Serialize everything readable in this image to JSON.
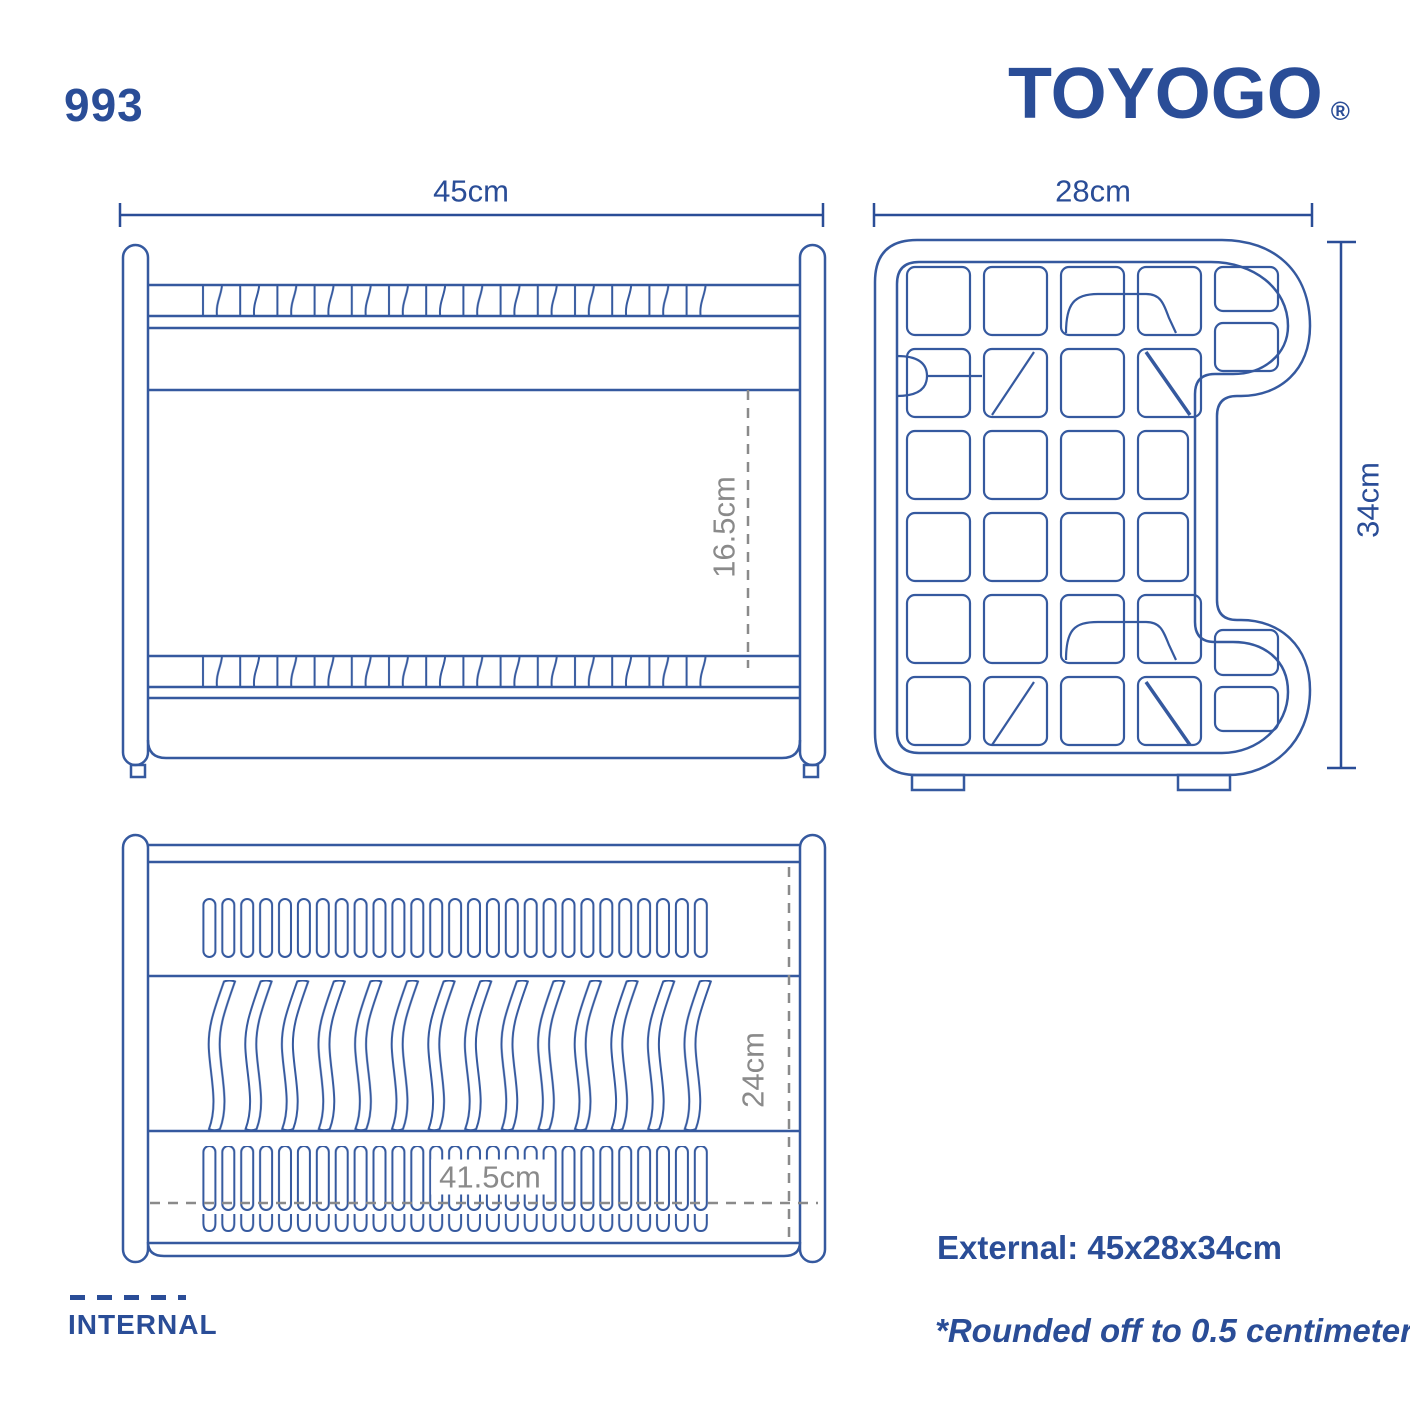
{
  "header": {
    "model_number": "993",
    "brand": "TOYOGO",
    "registered_mark": "®"
  },
  "views": {
    "front": {
      "external_width": "45cm",
      "internal_height": "16.5cm"
    },
    "side": {
      "external_depth": "28cm",
      "external_height": "34cm"
    },
    "top": {
      "internal_depth": "24cm",
      "internal_width": "41.5cm"
    }
  },
  "legend": {
    "internal_label": "INTERNAL"
  },
  "notes": {
    "external_dimensions": "External: 45x28x34cm",
    "rounding_note": "*Rounded off to 0.5 centimeter"
  },
  "colors": {
    "brand_blue": "#2A4D97",
    "line_blue": "#35599F",
    "dimension_gray": "#8A8A8A"
  }
}
